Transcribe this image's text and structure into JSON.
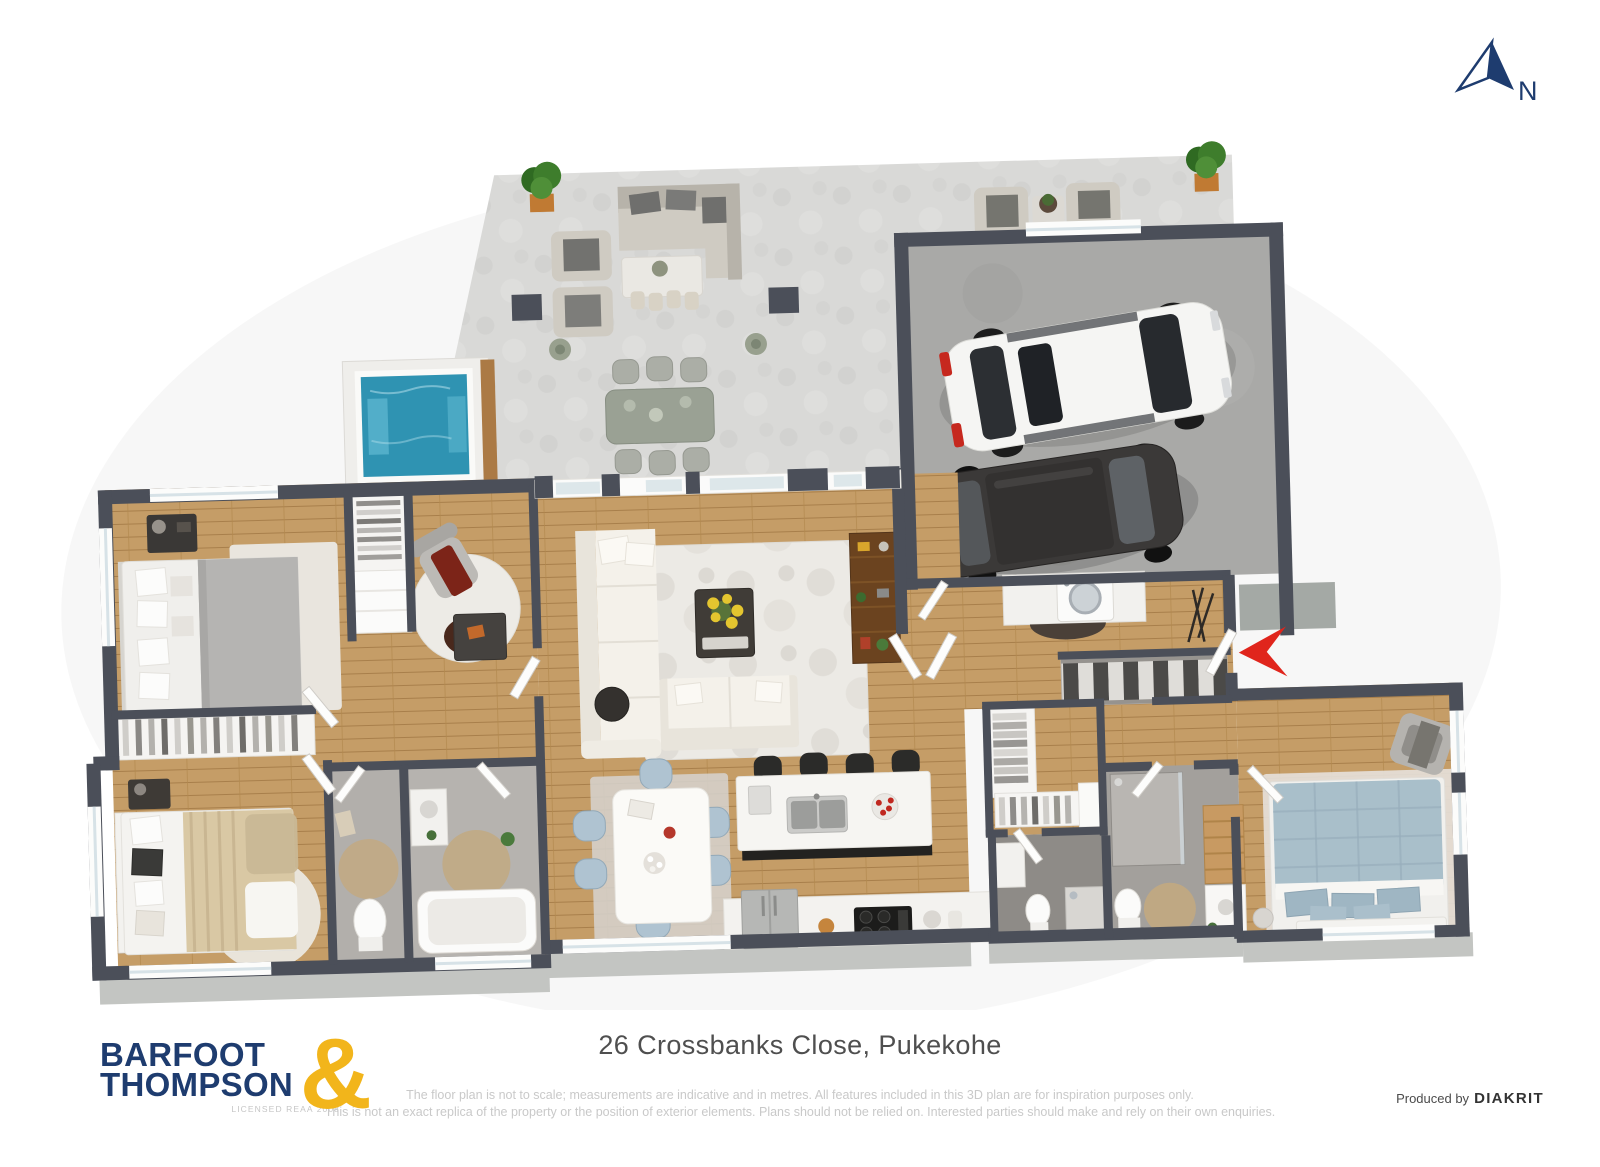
{
  "page": {
    "background": "#ffffff",
    "width": 1600,
    "height": 1167
  },
  "north_indicator": {
    "label": "N",
    "color": "#1e3c6f"
  },
  "entry_marker": {
    "shape": "arrow-pointing-left",
    "color": "#e0251c"
  },
  "palette": {
    "wall": "#4b4f59",
    "wood_floor": "#c59d67",
    "concrete_patio": "#d9d9d7",
    "garage_floor": "#a9a9a7",
    "bathroom_tile": "#b2afab",
    "ensuite_tile": "#a3a09c",
    "outdoor_deck": "#c3c5c2",
    "pool_water": "#2f93b2",
    "car_white": "#f5f5f3",
    "car_dark": "#3b3938",
    "logo_navy": "#1e3c6f",
    "logo_gold": "#f2b51b"
  },
  "scene": {
    "type": "3d-floor-plan",
    "areas": [
      "patio",
      "pool",
      "outdoor-lounge",
      "outdoor-dining",
      "garage-lounge",
      "garage",
      "living-room",
      "dining-area",
      "kitchen",
      "walk-in-robe",
      "laundry",
      "entry-hall",
      "stairs",
      "hallway",
      "bedroom-1",
      "wardrobe",
      "home-office",
      "bedroom-2",
      "toilet",
      "bathroom",
      "second-bathroom",
      "ensuite",
      "bedroom-3"
    ],
    "vehicles": [
      "white-suv",
      "dark-car"
    ]
  },
  "footer": {
    "address": "26 Crossbanks Close, Pukekohe",
    "disclaimer_line1": "The floor plan is not to scale; measurements are indicative and in metres. All features included in this 3D plan are for inspiration purposes only.",
    "disclaimer_line2": "This is not an exact replica of the property or the position of exterior elements. Plans should not be relied on. Interested parties should make and rely on their own enquiries.",
    "produced_by": {
      "label": "Produced by",
      "brand": "DIAKRIT"
    },
    "logo": {
      "word1": "BARFOOT",
      "word2": "THOMPSON",
      "ampersand": "&",
      "licence": "LICENSED REAA 2008"
    }
  }
}
